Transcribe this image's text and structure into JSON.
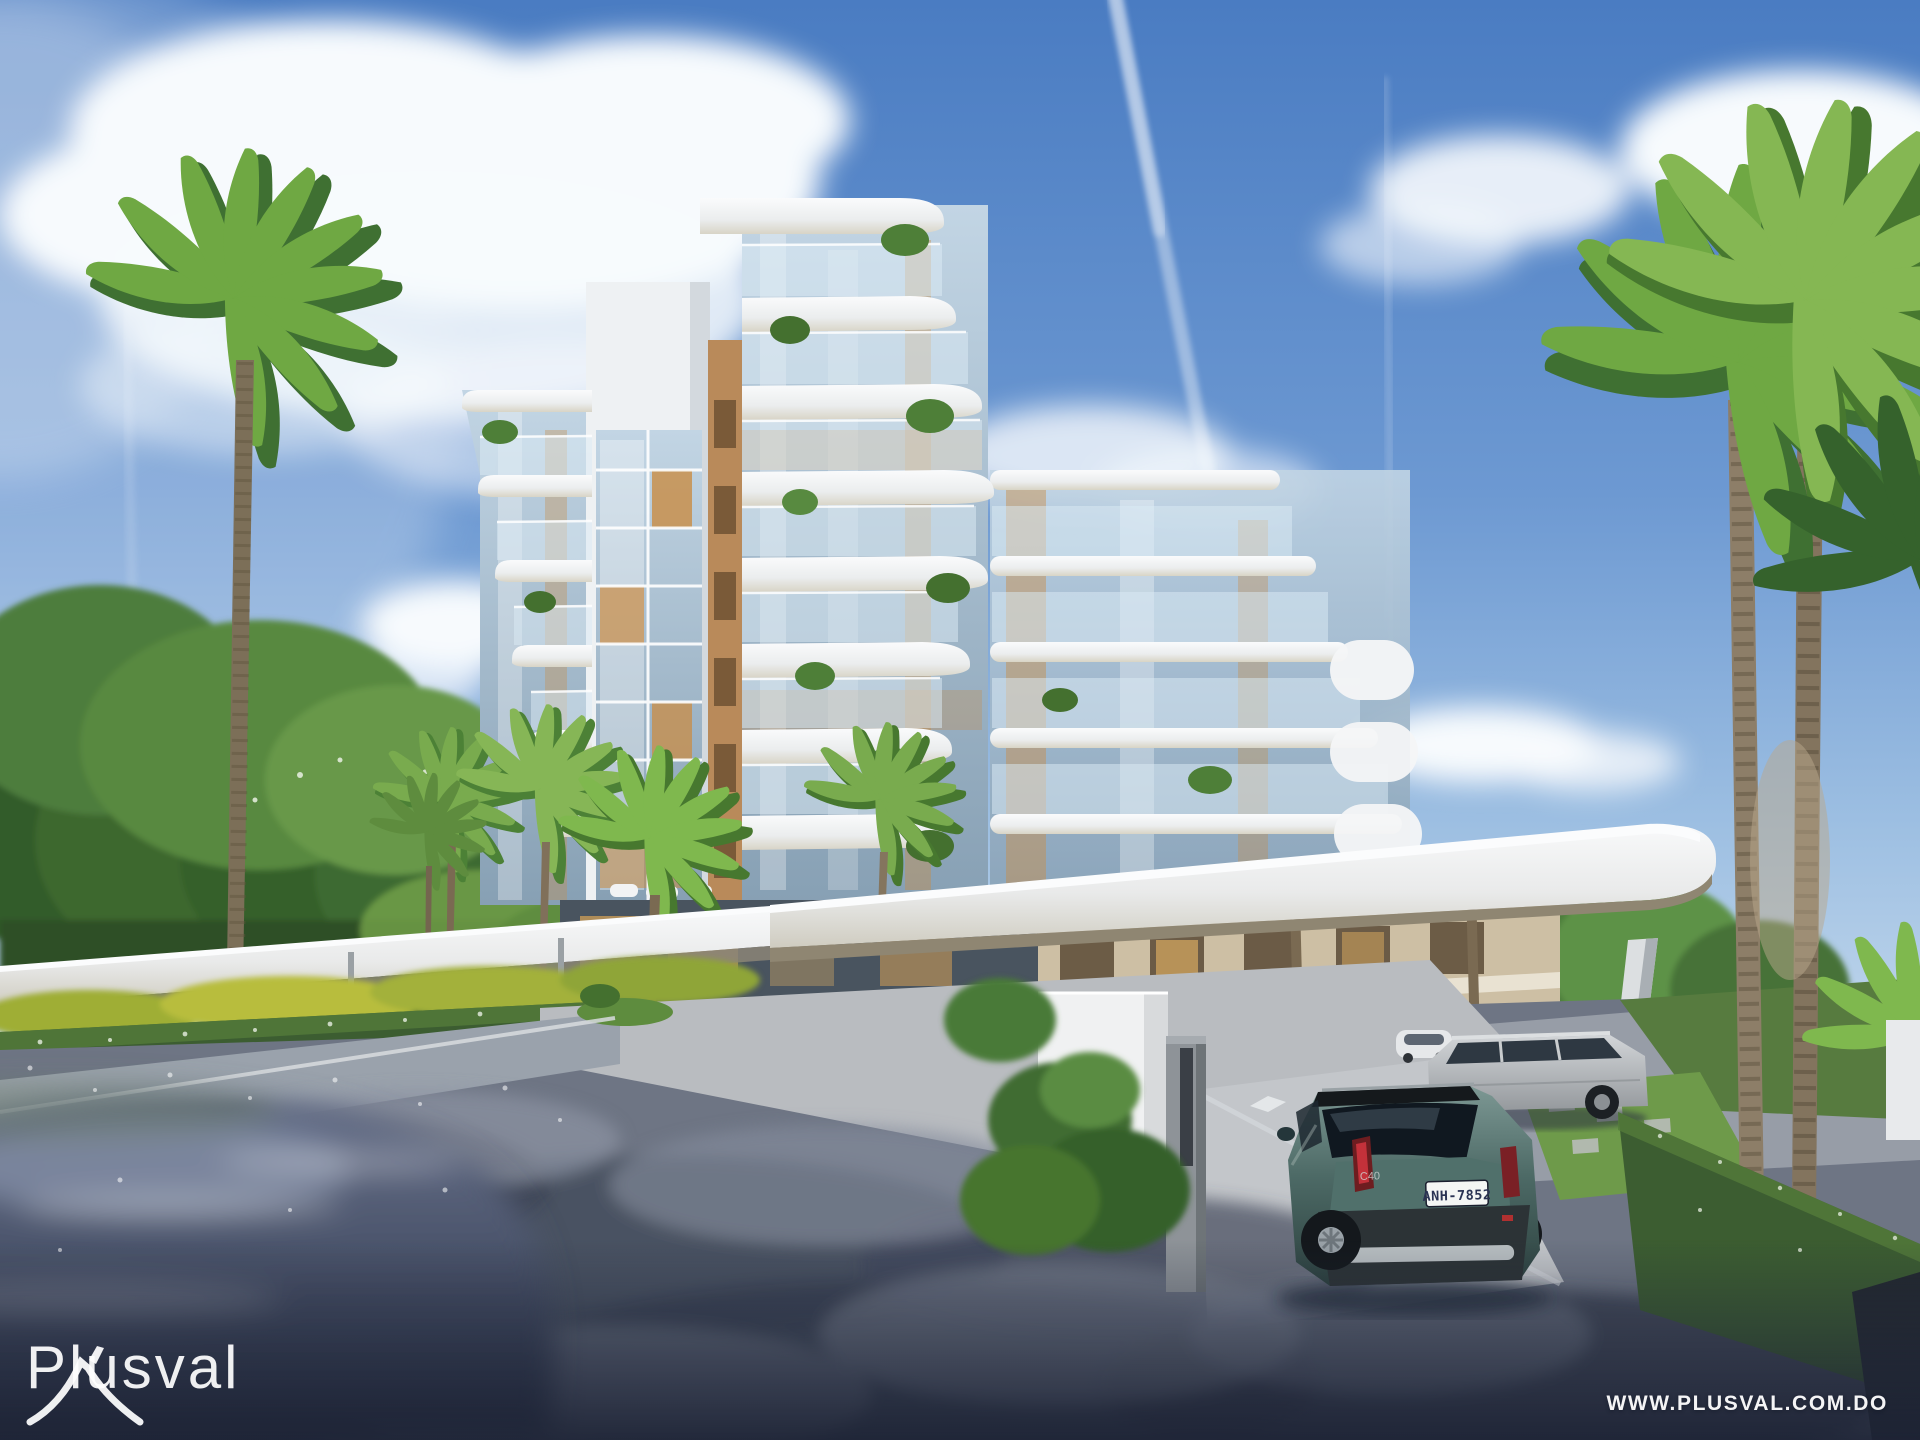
{
  "meta": {
    "scene_description": "3D exterior rendering of a modern white curved condominium building with tropical palm trees, a long entrance canopy, a hedge-lined street and vehicles on the driveway"
  },
  "watermark": {
    "brand": "Plusval",
    "brand_icon": "mountain-peak-icon",
    "website_url": "WWW.PLUSVAL.COM.DO"
  },
  "vehicles": {
    "teal_suv_plate": "ANH-7852",
    "teal_suv_badge": "C40"
  },
  "colors": {
    "sky_top": "#4a7cc2",
    "sky_horizon": "#c9dcee",
    "cloud_white": "#f7fafd",
    "building_white": "#f2f4f6",
    "slab_beige": "#cdbfa4",
    "canopy_soffit": "#8f8672",
    "glass_blue": "#a3bdd6",
    "interior_amber": "#c98c44",
    "foliage_dark": "#2e5026",
    "foliage_bright": "#6fa84a",
    "palm_trunk": "#8d7e68",
    "hedge_green": "#3c5d31",
    "road_light": "#b9bcc0",
    "road_dark": "#3e4555",
    "shadow_navy": "#232a3d",
    "car_teal": "#4d6a66",
    "car_silver": "#b4b8bb",
    "plate_text_color": "#2a3353",
    "watermark_white": "#ffffff"
  }
}
